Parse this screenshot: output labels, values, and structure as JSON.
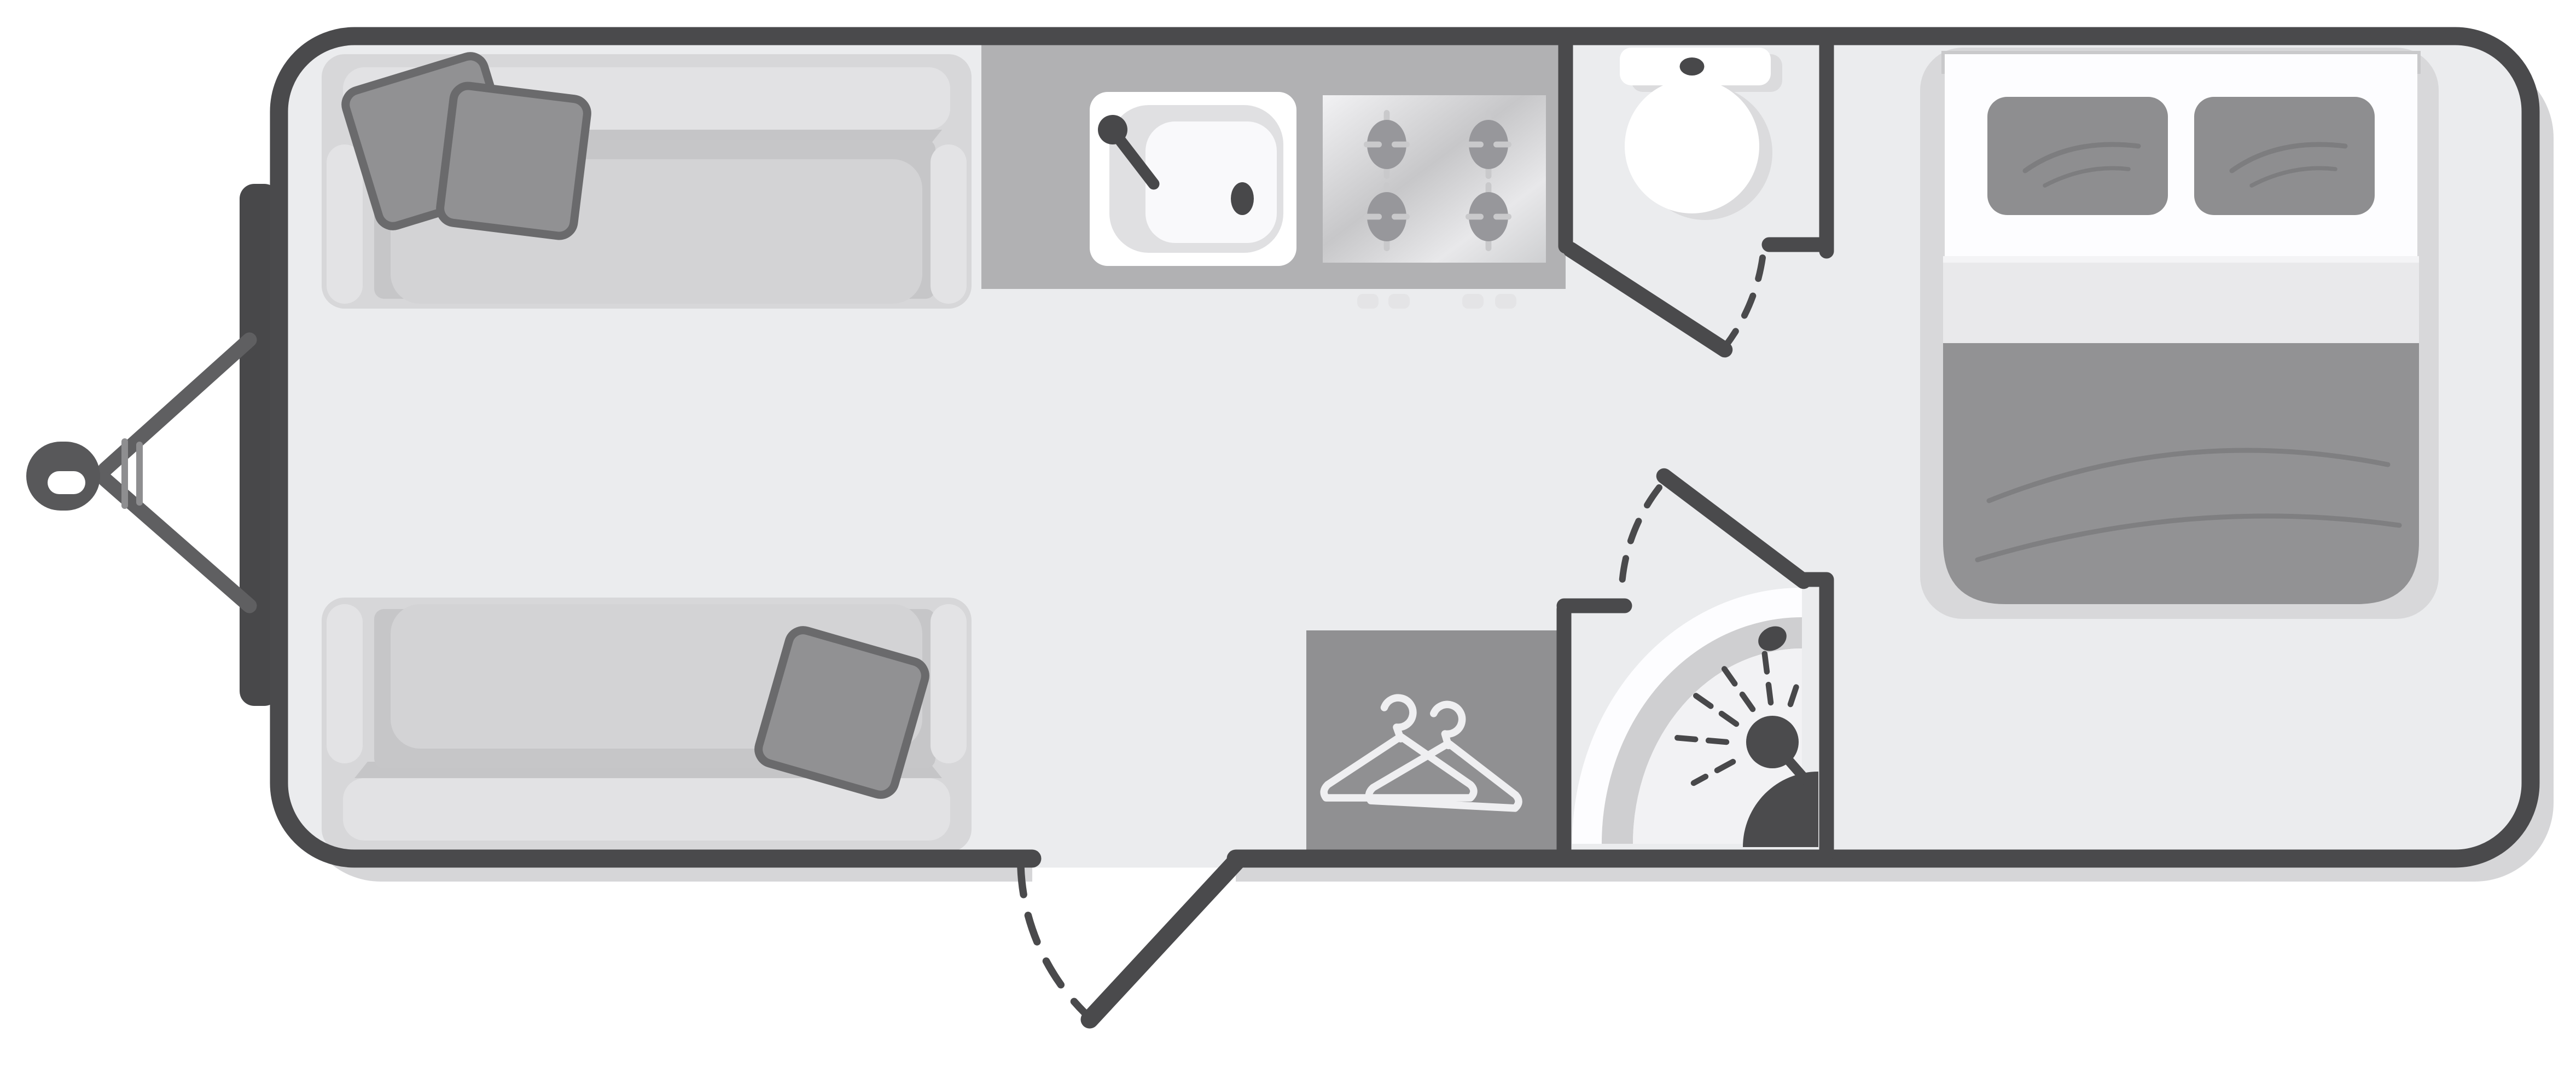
{
  "page": {
    "title": "Caravan floor plan diagram",
    "background": "#ffffff"
  },
  "diagram": {
    "type": "caravan-floor-plan",
    "view": "top-down",
    "tow_hitch_side": "left",
    "rooms": [
      {
        "id": "lounge",
        "name": "front-lounge-twin-sofas"
      },
      {
        "id": "kitchen",
        "name": "kitchen-sink-and-four-burner-hob"
      },
      {
        "id": "toilet-room",
        "name": "toilet-compartment"
      },
      {
        "id": "wardrobe",
        "name": "wardrobe-with-hangers"
      },
      {
        "id": "shower-room",
        "name": "corner-shower"
      },
      {
        "id": "bedroom",
        "name": "rear-double-bed"
      }
    ],
    "fixtures": [
      "tow-coupling",
      "a-frame-drawbar",
      "sofa",
      "scatter-cushions",
      "kitchen-sink",
      "tap",
      "hob-burners",
      "toilet",
      "toilet-door",
      "entry-door",
      "wardrobe-hangers",
      "quadrant-shower-tray",
      "shower-head",
      "double-bed",
      "bed-pillows",
      "duvet"
    ],
    "doors": [
      {
        "name": "toilet-door",
        "state": "open",
        "swing": "dashed-arc"
      },
      {
        "name": "shower-door",
        "state": "open",
        "swing": "dashed-arc"
      },
      {
        "name": "entry-door",
        "state": "open",
        "swing": "dashed-arc"
      }
    ]
  },
  "colors": {
    "wall": "#4a4a4c",
    "floor": "#ebecee",
    "body_shadow": "#d6d6d8",
    "bumper": "#48484a",
    "hitch": "#5f5f61",
    "hitch_detail": "#8e8e90",
    "coupling": "#58585a",
    "white": "#ffffff",
    "sofa_body": "#d7d7d9",
    "sofa_back": "#e2e2e4",
    "sofa_well": "#c6c6c8",
    "sofa_cushion": "#d3d3d5",
    "sofa_arm": "#e3e3e5",
    "sofa_shadow": "#b9b9bb",
    "pillow": "#919193",
    "pillow_edge": "#6a6a6c",
    "counter": "#b1b1b3",
    "sink_bowl": "#e0e0e2",
    "sink_inner": "#f9f9fb",
    "fixture_dark": "#48484a",
    "burner": "#97979b",
    "burner_tick": "#c9c9cb",
    "pull": "#e4e4e6",
    "ceramic_shadow": "#dbdbdd",
    "wardrobe": "#909092",
    "hanger": "#efeff1",
    "tray_outer": "#fdfdff",
    "tray_band": "#cfcfd1",
    "tray_inner": "#f2f2f4",
    "shower_dark": "#4b4b4d",
    "bed_base": "#d8d8da",
    "bed_sheet": "#fdfdff",
    "bed_fold": "#e9e9eb",
    "duvet": "#929294",
    "duvet_crease": "#7f7f81",
    "bed_pillow": "#8e8e90",
    "bed_pillow_crease": "#7d7d7f",
    "headboard_shadow": "#c9c9cb"
  }
}
